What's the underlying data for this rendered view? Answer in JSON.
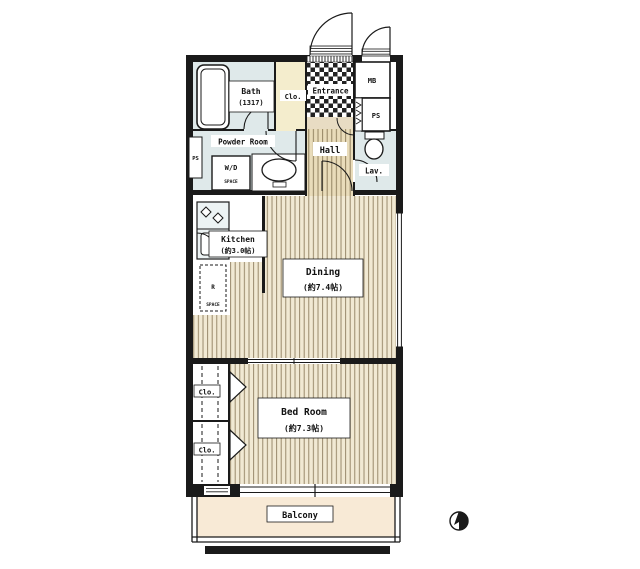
{
  "floorplan": {
    "rooms": {
      "bath": {
        "label": "Bath",
        "size": "(1317)"
      },
      "closet_top": {
        "label": "Clo."
      },
      "entrance": {
        "label": "Entrance"
      },
      "meter_box": {
        "label": "MB"
      },
      "pipe_shaft_right": {
        "label": "PS"
      },
      "pipe_shaft_left": {
        "label": "PS"
      },
      "powder_room": {
        "label": "Powder Room"
      },
      "washer_dryer": {
        "label": "W/D",
        "sublabel": "SPACE"
      },
      "hall": {
        "label": "Hall"
      },
      "lavatory": {
        "label": "Lav."
      },
      "kitchen": {
        "label": "Kitchen",
        "size": "(約3.0帖)"
      },
      "refrigerator": {
        "label": "R",
        "sublabel": "SPACE"
      },
      "dining": {
        "label": "Dining",
        "size": "(約7.4帖)"
      },
      "closet_1": {
        "label": "Clo."
      },
      "closet_2": {
        "label": "Clo."
      },
      "bedroom": {
        "label": "Bed Room",
        "size": "(約7.3帖)"
      },
      "balcony": {
        "label": "Balcony"
      }
    },
    "icons": {
      "compass": "north-indicator"
    },
    "colors": {
      "wall": "#1a1a1a",
      "wet_area_floor": "#dfe9ea",
      "closet_fill": "#f4edcd",
      "wood_floor": "#f1e9d3",
      "wood_grain_line": "#8f7f60",
      "hall_floor": "#e9dcba",
      "entrance_step": "#e8dcc3",
      "balcony_floor": "#f8ead6",
      "counter": "#edf3f4"
    }
  }
}
